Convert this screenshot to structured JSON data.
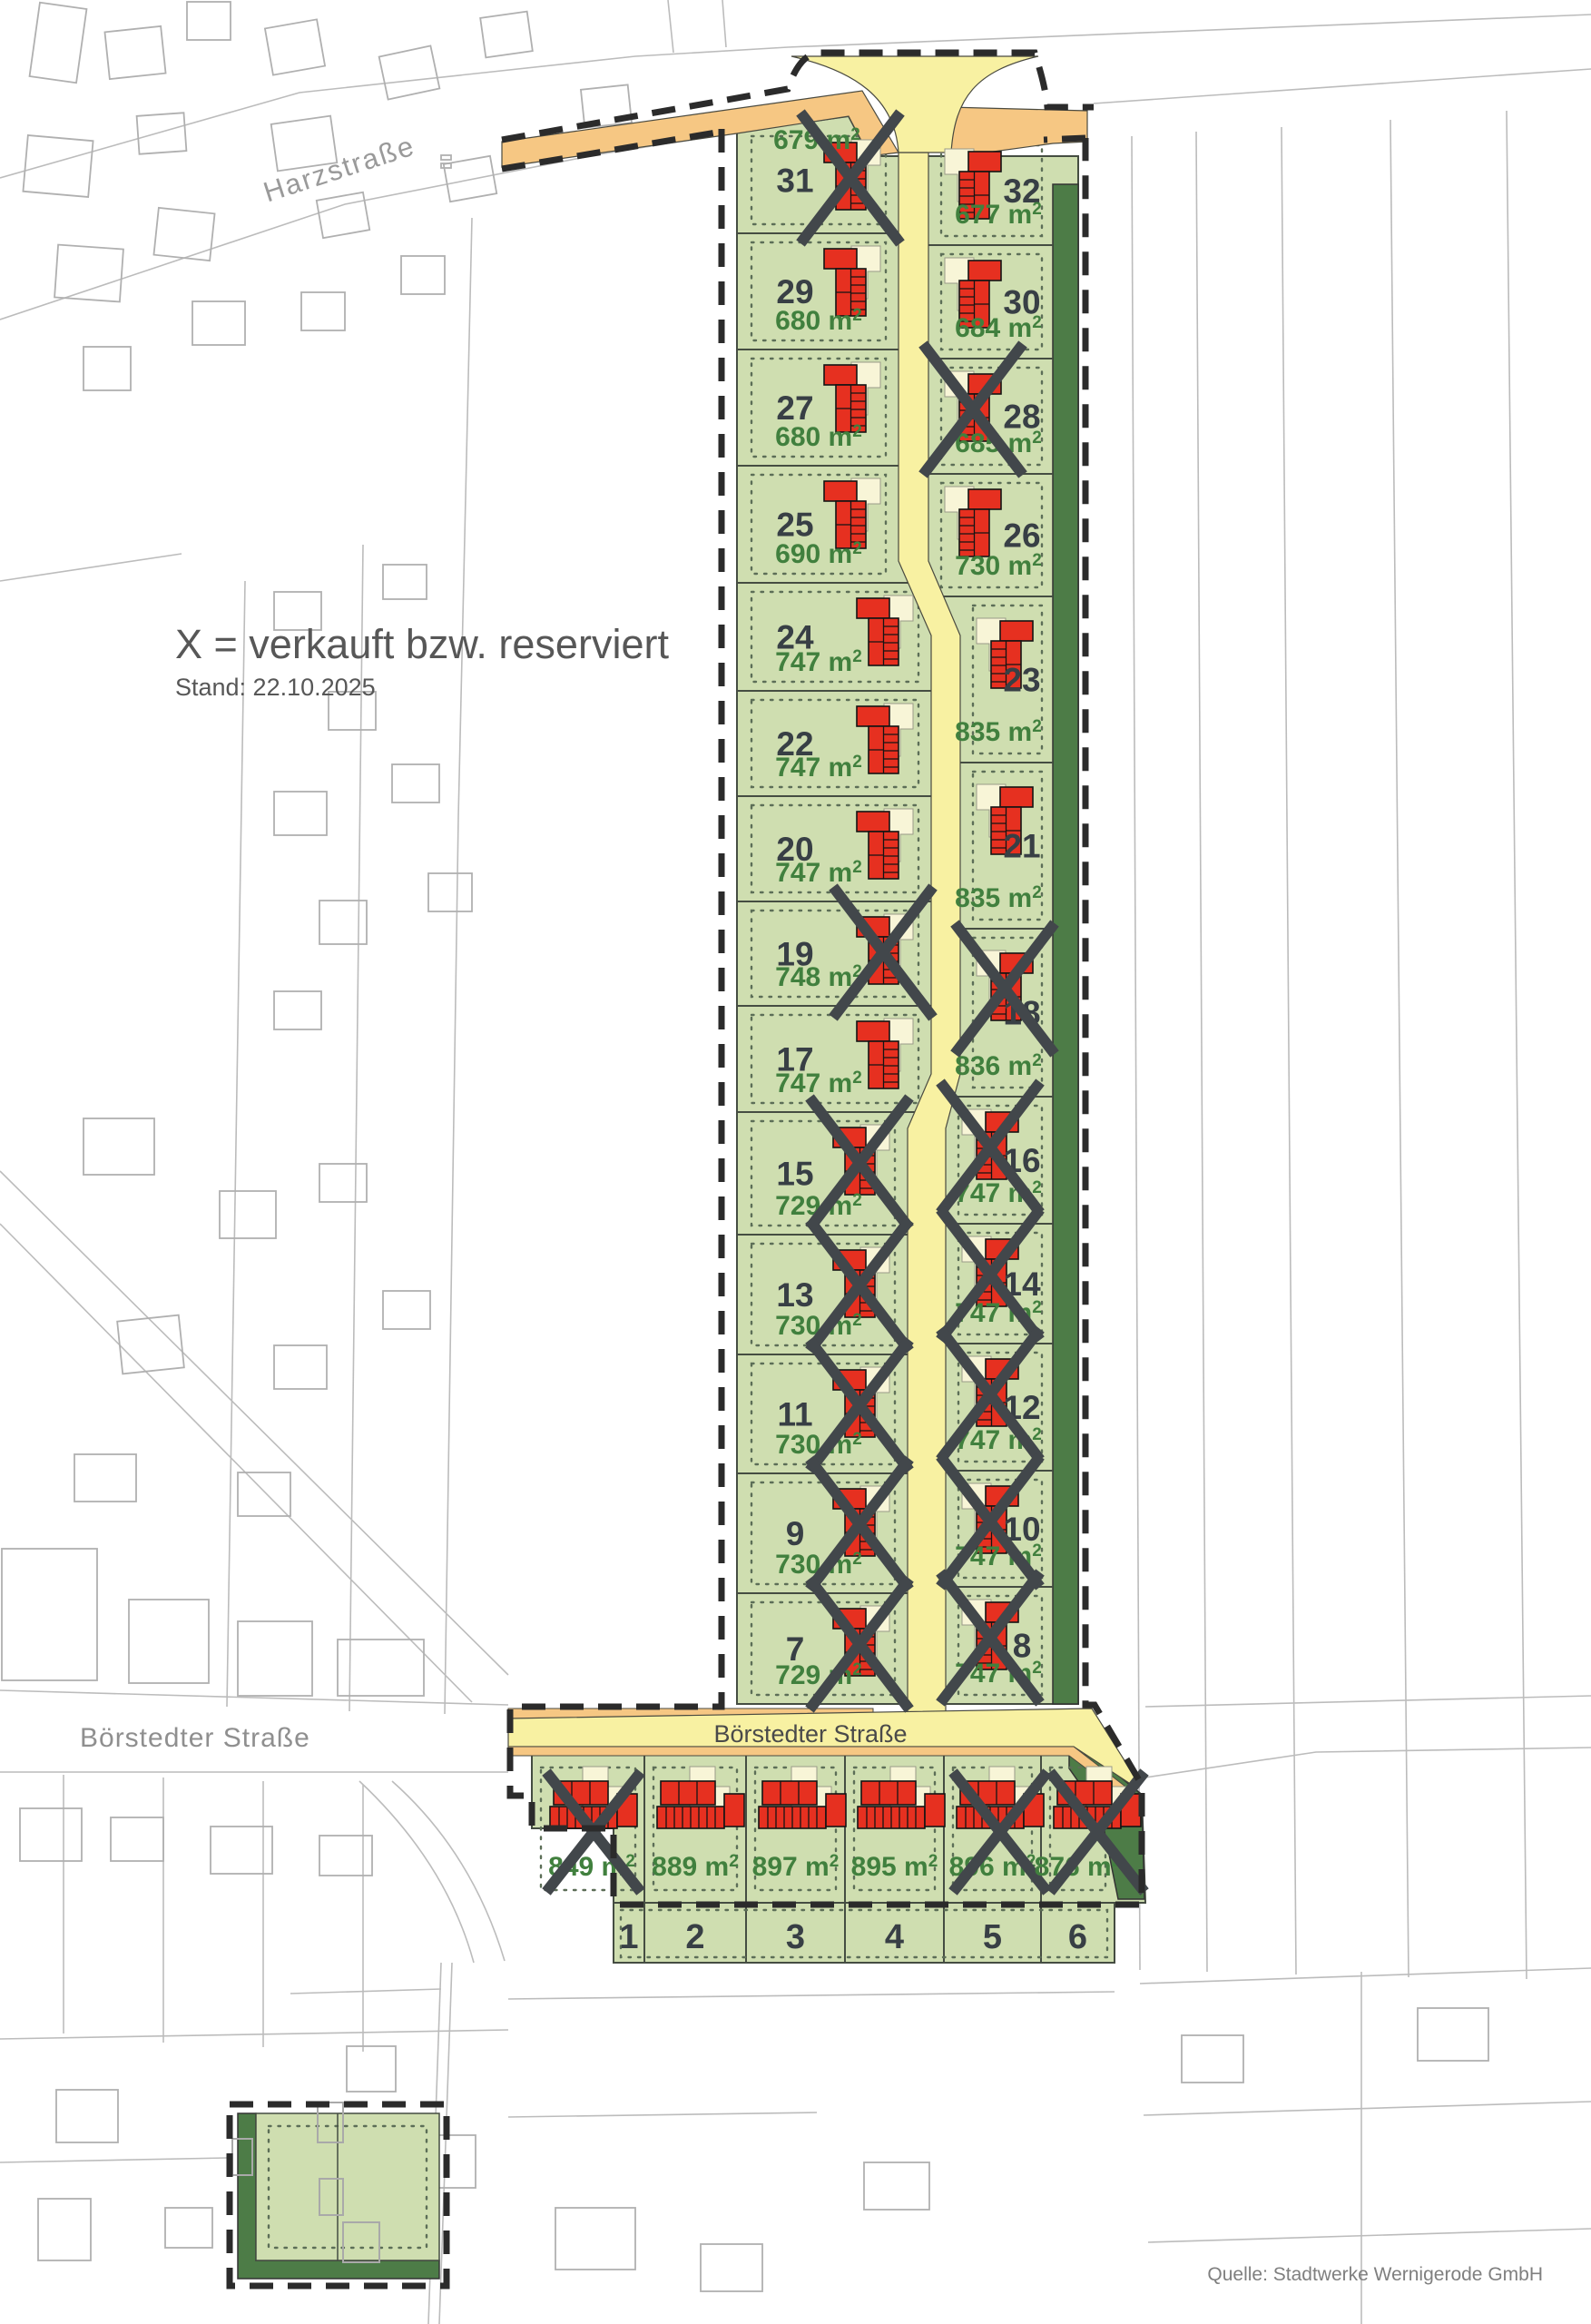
{
  "map": {
    "legend": {
      "title": "X = verkauft bzw. reserviert",
      "date": "Stand: 22.10.2025"
    },
    "source": "Quelle: Stadtwerke Wernigerode GmbH",
    "streets": {
      "harzstrasse": "Harzstraße",
      "boerstedter_west": "Börstedter Straße",
      "boerstedter_new": "Börstedter Straße"
    },
    "area_unit": "m²",
    "colors": {
      "plot_green": "#cfdeb0",
      "road_yellow": "#f8f1a2",
      "sidewalk_orange": "#f6c783",
      "reserve_dark_green": "#4d7c47",
      "house_red": "#e63020",
      "patio_cream": "#f8f5d7",
      "sold_x": "#42474b",
      "area_text": "#41803e",
      "number_text": "#383f45",
      "parcel_line": "#454d42",
      "dashed_boundary": "#2b2b2b",
      "background_line": "#bcbcbc"
    },
    "plots": {
      "left_column": [
        {
          "number": 31,
          "area_m2": 679,
          "sold": true
        },
        {
          "number": 29,
          "area_m2": 680,
          "sold": false
        },
        {
          "number": 27,
          "area_m2": 680,
          "sold": false
        },
        {
          "number": 25,
          "area_m2": 690,
          "sold": false
        },
        {
          "number": 24,
          "area_m2": 747,
          "sold": false
        },
        {
          "number": 22,
          "area_m2": 747,
          "sold": false
        },
        {
          "number": 20,
          "area_m2": 747,
          "sold": false
        },
        {
          "number": 19,
          "area_m2": 748,
          "sold": true
        },
        {
          "number": 17,
          "area_m2": 747,
          "sold": false
        },
        {
          "number": 15,
          "area_m2": 729,
          "sold": true
        },
        {
          "number": 13,
          "area_m2": 730,
          "sold": true
        },
        {
          "number": 11,
          "area_m2": 730,
          "sold": true
        },
        {
          "number": 9,
          "area_m2": 730,
          "sold": true
        },
        {
          "number": 7,
          "area_m2": 729,
          "sold": true
        }
      ],
      "right_column": [
        {
          "number": 32,
          "area_m2": 677,
          "sold": false
        },
        {
          "number": 30,
          "area_m2": 684,
          "sold": false
        },
        {
          "number": 28,
          "area_m2": 685,
          "sold": true
        },
        {
          "number": 26,
          "area_m2": 730,
          "sold": false
        },
        {
          "number": 23,
          "area_m2": 835,
          "sold": false
        },
        {
          "number": 21,
          "area_m2": 835,
          "sold": false
        },
        {
          "number": 18,
          "area_m2": 836,
          "sold": true
        },
        {
          "number": 16,
          "area_m2": 747,
          "sold": true
        },
        {
          "number": 14,
          "area_m2": 747,
          "sold": true
        },
        {
          "number": 12,
          "area_m2": 747,
          "sold": true
        },
        {
          "number": 10,
          "area_m2": 747,
          "sold": true
        },
        {
          "number": 8,
          "area_m2": 747,
          "sold": true
        }
      ],
      "bottom_row": [
        {
          "number": 1,
          "area_m2": 849,
          "sold": true
        },
        {
          "number": 2,
          "area_m2": 889,
          "sold": false
        },
        {
          "number": 3,
          "area_m2": 897,
          "sold": false
        },
        {
          "number": 4,
          "area_m2": 895,
          "sold": false
        },
        {
          "number": 5,
          "area_m2": 896,
          "sold": true
        },
        {
          "number": 6,
          "area_m2": 876,
          "sold": true
        }
      ]
    }
  }
}
